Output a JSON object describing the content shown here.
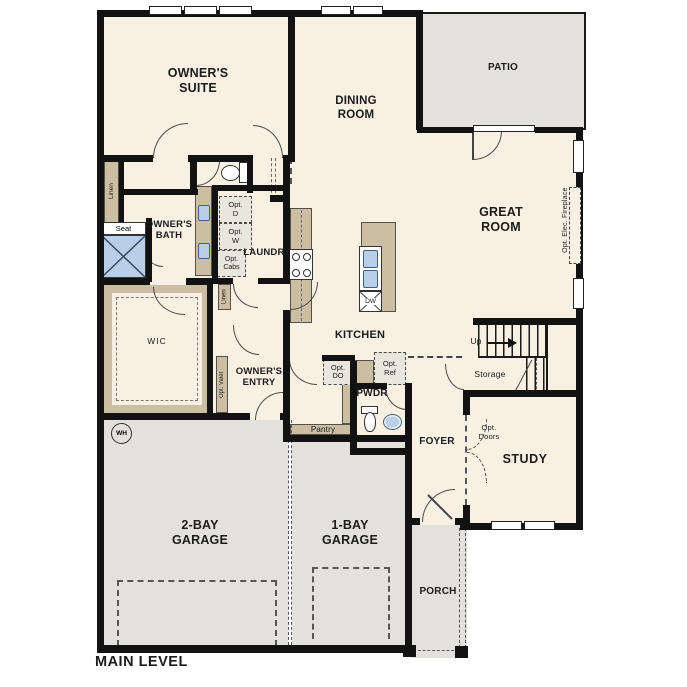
{
  "title": "MAIN LEVEL",
  "palette": {
    "floor": "#f8f0e2",
    "exterior_concrete": "#e2e1de",
    "casework_tan": "#cbbea3",
    "fixture_blue": "#b9cfe8",
    "wall_black": "#111111"
  },
  "rooms": {
    "owners_suite": "OWNER'S\nSUITE",
    "dining": "DINING\nROOM",
    "patio": "PATIO",
    "great_room": "GREAT\nROOM",
    "owners_bath": "OWNER'S\nBATH",
    "laundry": "LAUNDRY",
    "wic": "WIC",
    "owners_entry": "OWNER'S\nENTRY",
    "kitchen": "KITCHEN",
    "pwdr": "PWDR",
    "foyer": "FOYER",
    "study": "STUDY",
    "storage": "Storage",
    "garage_2bay": "2-BAY\nGARAGE",
    "garage_1bay": "1-BAY\nGARAGE",
    "porch": "PORCH"
  },
  "annotations": {
    "linen_bath": "Linen",
    "seat": "Seat",
    "linen_hall": "Linen",
    "opt_dryer": "Opt.\nD",
    "opt_washer": "Opt.\nW",
    "opt_cabs": "Opt.\nCabs",
    "opt_valet": "Opt. Valet",
    "opt_double_oven": "Opt.\nDO",
    "opt_refrigerator": "Opt.\nRef",
    "pantry": "Pantry",
    "dishwasher": "DW",
    "stairs_up": "Up",
    "water_heater": "WH",
    "opt_doors": "Opt.\nDoors",
    "opt_elec_fireplace": "Opt. Elec. Fireplace"
  }
}
